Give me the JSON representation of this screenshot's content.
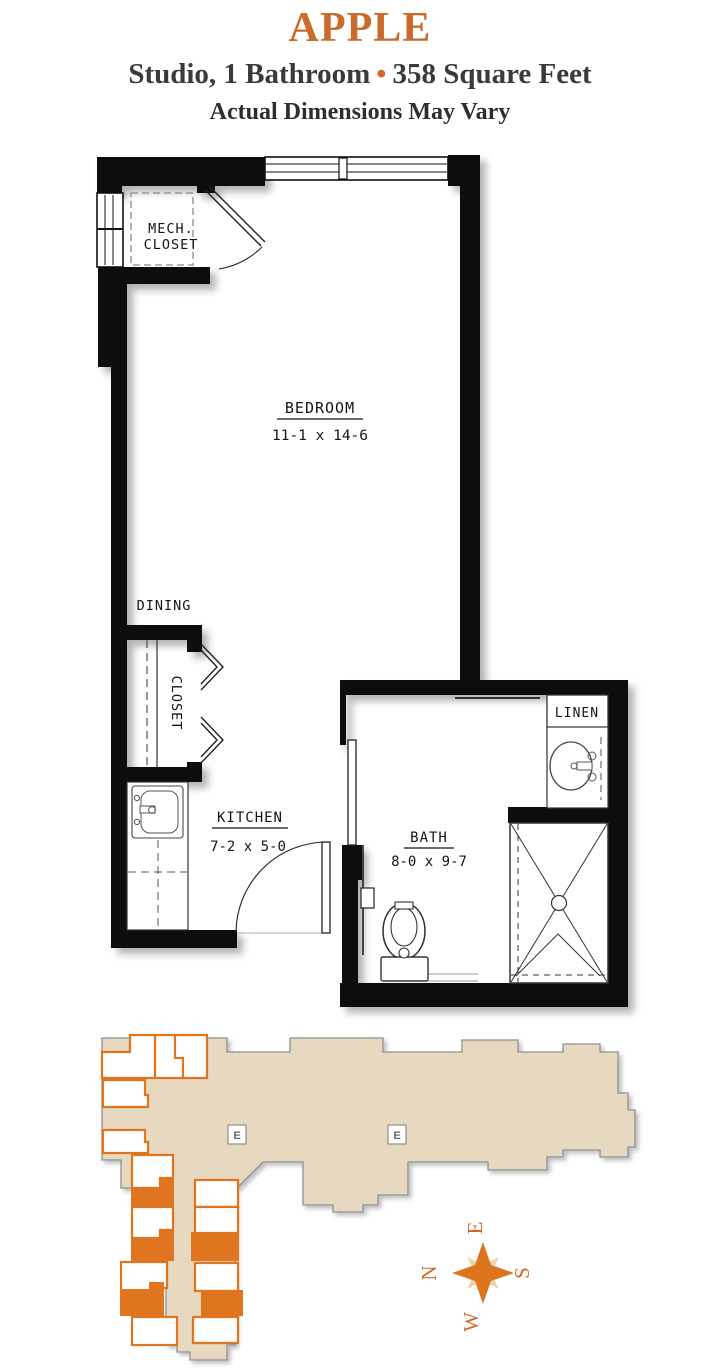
{
  "header": {
    "plan_name": "APPLE",
    "subtitle_left": "Studio, 1 Bathroom",
    "bullet": "•",
    "subtitle_right": "358 Square Feet",
    "disclaimer": "Actual Dimensions May Vary"
  },
  "floor_plan": {
    "rooms": {
      "bedroom": {
        "name": "BEDROOM",
        "dims": "11-1 x 14-6"
      },
      "kitchen": {
        "name": "KITCHEN",
        "dims": "7-2 x 5-0"
      },
      "bath": {
        "name": "BATH",
        "dims": "8-0 x 9-7"
      },
      "dining": {
        "name": "DINING"
      },
      "closet": {
        "name": "CLOSET"
      },
      "linen": {
        "name": "LINEN"
      },
      "mech_closet_line1": "MECH.",
      "mech_closet_line2": "CLOSET"
    }
  },
  "site_plan": {
    "elevator_label": "E",
    "compass": {
      "n": "N",
      "e": "E",
      "s": "S",
      "w": "W"
    }
  },
  "colors": {
    "accent_orange": "#c96b2b",
    "text_dark": "#3a3a3a",
    "plan_wall": "#0a0a0a",
    "building_fill": "#e7d8c0",
    "building_outline": "#8f8f8f",
    "unit_outline": "#e0751f",
    "unit_highlight_fill": "#e0751f",
    "compass_light": "#f2d0a8",
    "compass_dark": "#dd741e"
  }
}
